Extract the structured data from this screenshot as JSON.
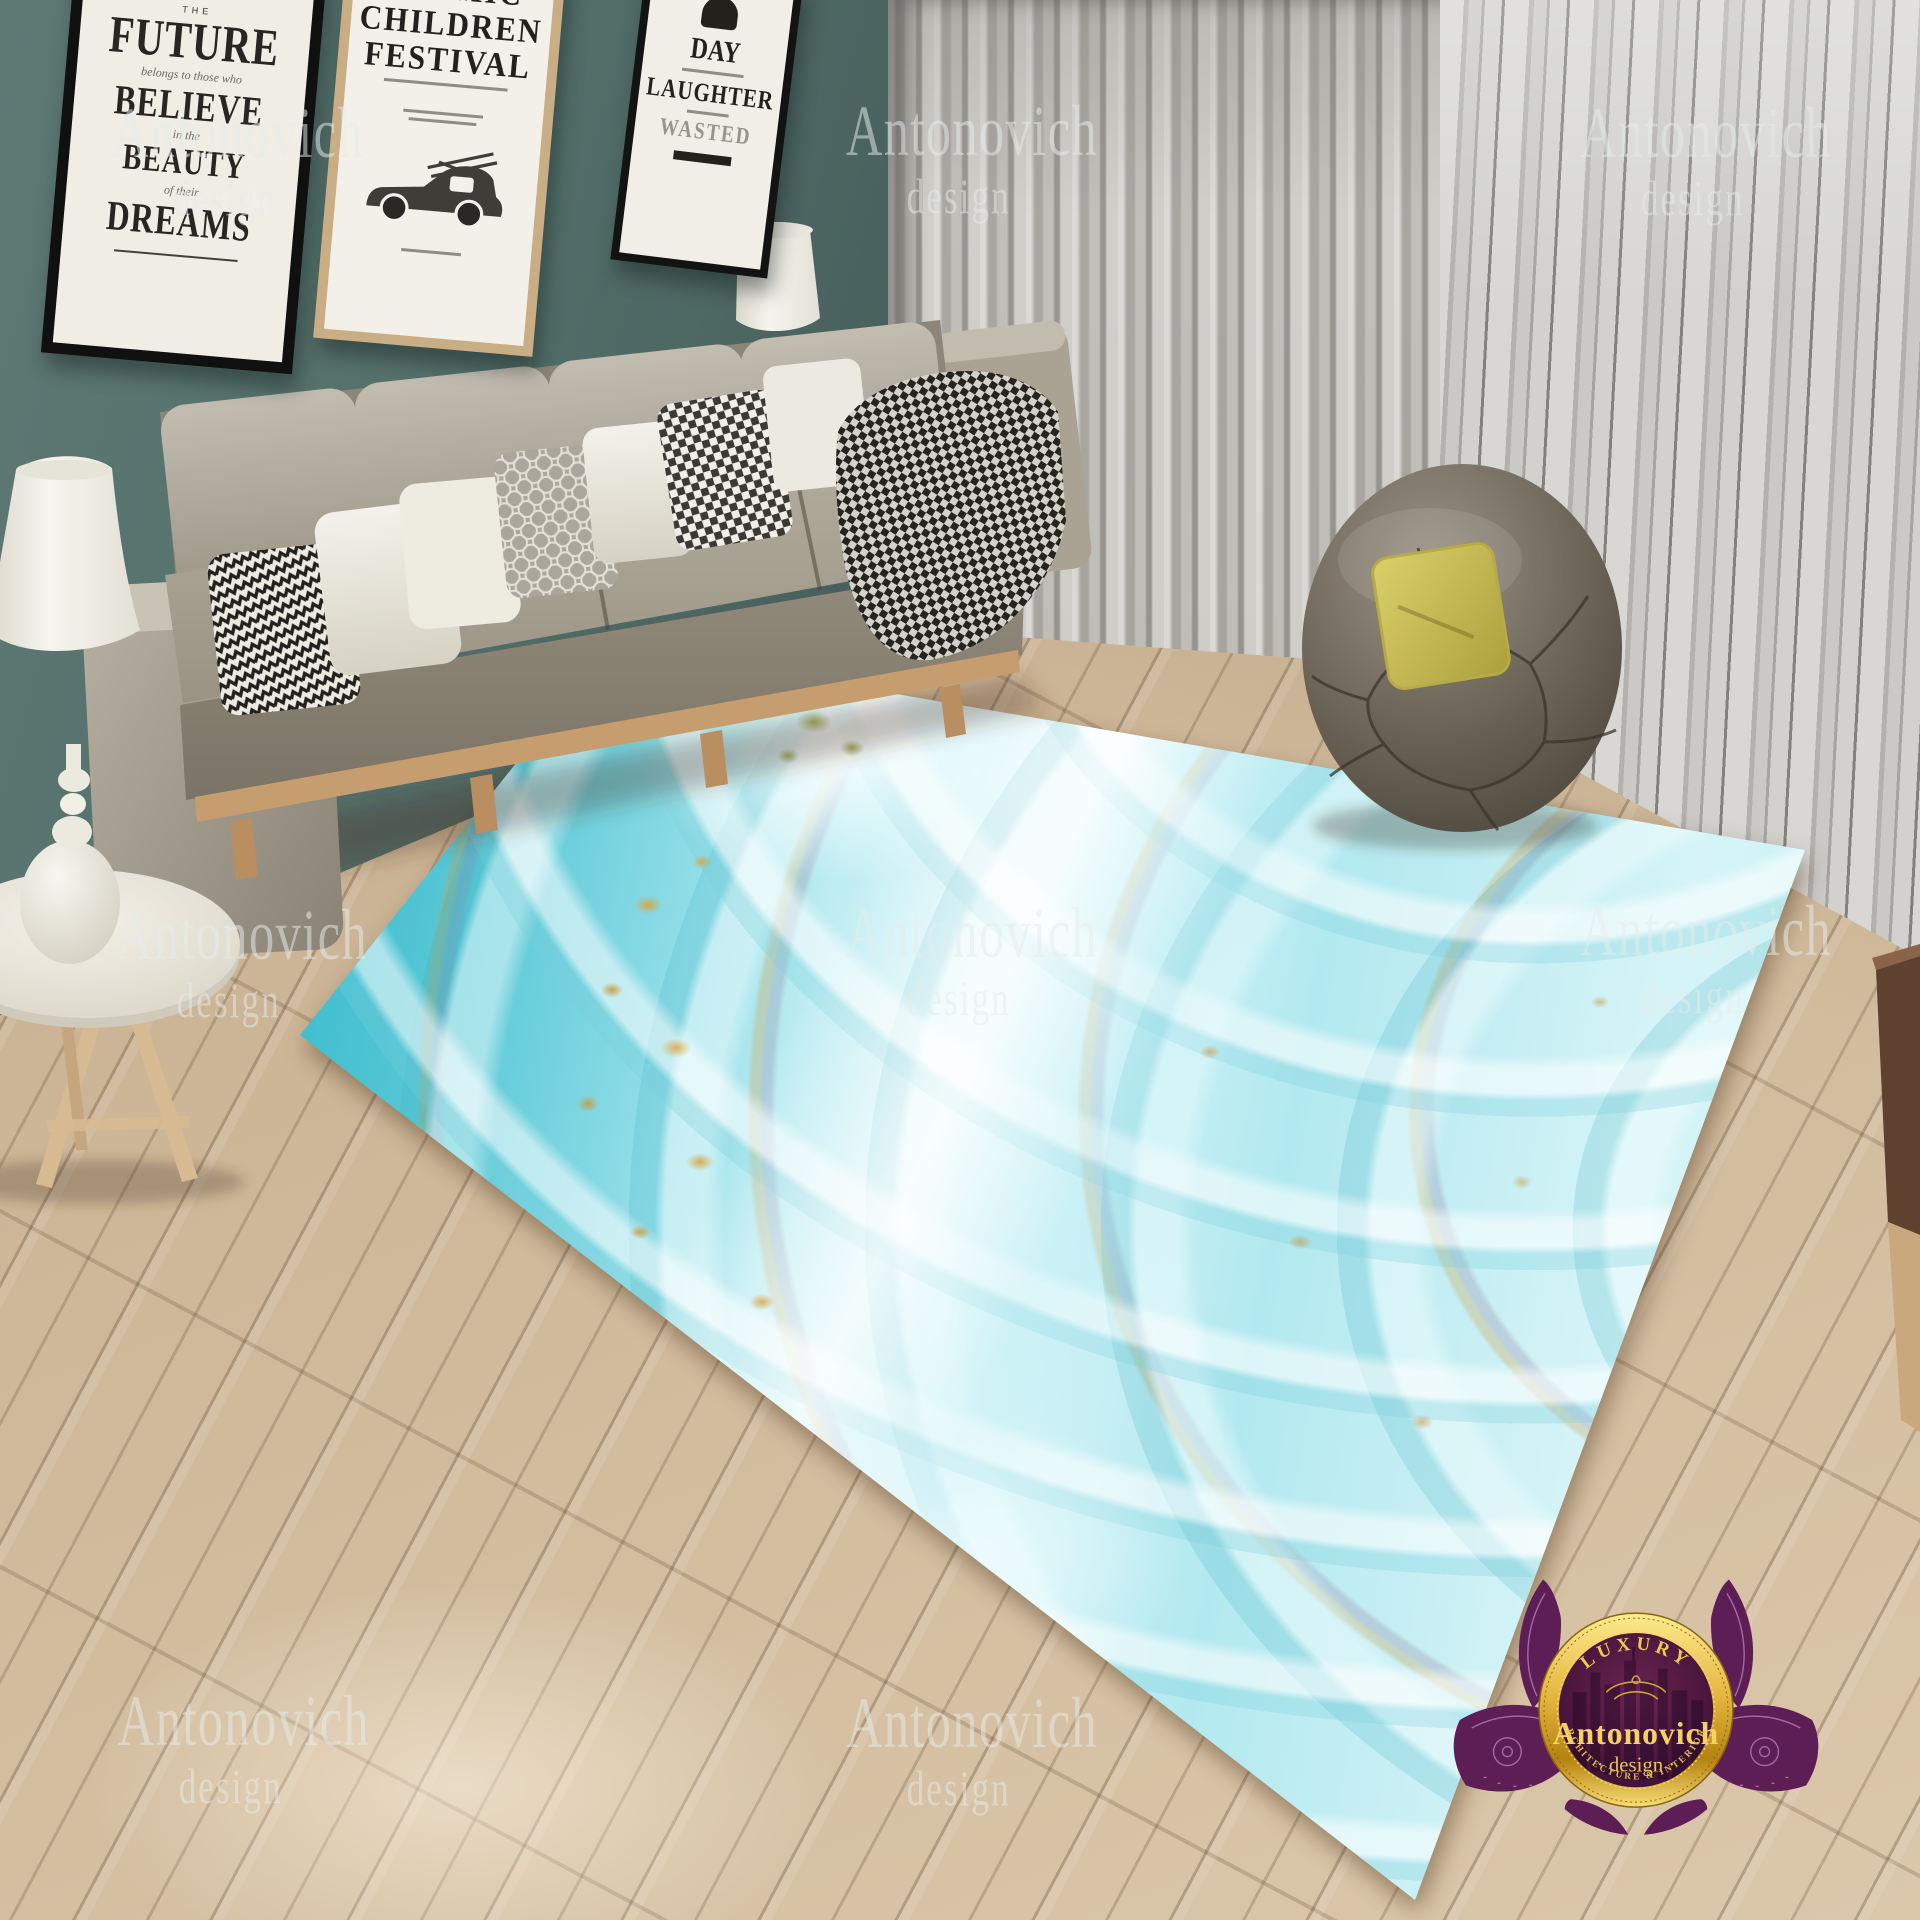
{
  "posters": {
    "p1": {
      "top_word": "THE",
      "word1": "FUTURE",
      "script1": "belongs to those who",
      "word2": "BELIEVE",
      "script2": "in the",
      "word3": "BEAUTY",
      "script3": "of their",
      "word4": "DREAMS"
    },
    "p2": {
      "line1": "COSMIC",
      "line2": "CHILDREN",
      "line3": "FESTIVAL"
    },
    "p3": {
      "word1": "DAY",
      "word2": "LAUGHTER",
      "word3": "WASTED"
    }
  },
  "watermark": {
    "line1": "Antonovich",
    "line2": "design"
  },
  "logo": {
    "arc_top": "LUXURY",
    "name": "Antonovich",
    "name_sub": "· design ·",
    "arc_bottom": "ARCHITECTURE & INTERIORS"
  },
  "palette": {
    "wall_teal": "#54706b",
    "rug_teal": "#22aabc",
    "rug_aqua": "#a7e6ee",
    "rug_gold": "#d8a640",
    "sofa_gray": "#a8a192",
    "floor_wood": "#ccb596",
    "logo_purple": "#5c1e55",
    "logo_gold": "#e3b33c",
    "pillow_yellow": "#cfc253"
  }
}
